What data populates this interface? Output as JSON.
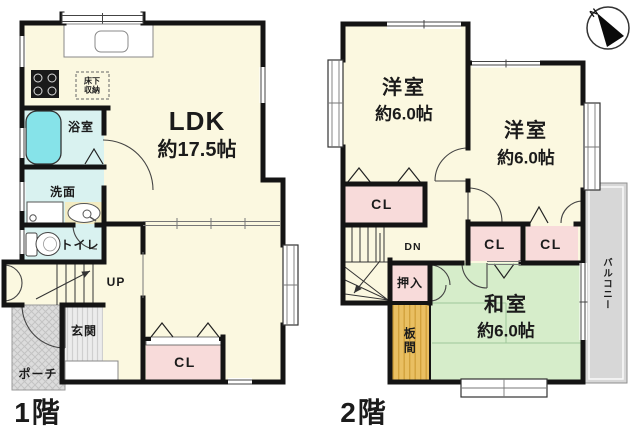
{
  "compass": {
    "north": "N"
  },
  "floor1": {
    "floor_label": "1階",
    "ldk": {
      "name": "LDK",
      "size": "約17.5帖"
    },
    "bath": "浴室",
    "washroom": "洗面",
    "toilet": "トイレ",
    "stairs": "UP",
    "entrance": "玄関",
    "porch": "ポーチ",
    "closet": "CL",
    "underfloor_storage": {
      "line1": "床下",
      "line2": "収納"
    }
  },
  "floor2": {
    "floor_label": "2階",
    "western_room_1": {
      "name": "洋室",
      "size": "約6.0帖"
    },
    "western_room_2": {
      "name": "洋室",
      "size": "約6.0帖"
    },
    "japanese_room": {
      "name": "和室",
      "size": "約6.0帖"
    },
    "closet_1": "CL",
    "closet_2": "CL",
    "closet_3": "CL",
    "oshiire": "押入",
    "itanoma": "板間",
    "balcony": "バルコニー",
    "stairs": "DN"
  },
  "colors": {
    "wall": "#141414",
    "room_cream": "#fbf8e0",
    "wet_area_blue": "#d9f2f0",
    "tub_cyan": "#86e3e9",
    "closet_pink": "#f8dbda",
    "tatami_green": "#d6edca",
    "itanoma_orange": "#e9bf62",
    "porch_gray": "#dcdcdc",
    "balcony_gray": "#d7d7d7"
  }
}
